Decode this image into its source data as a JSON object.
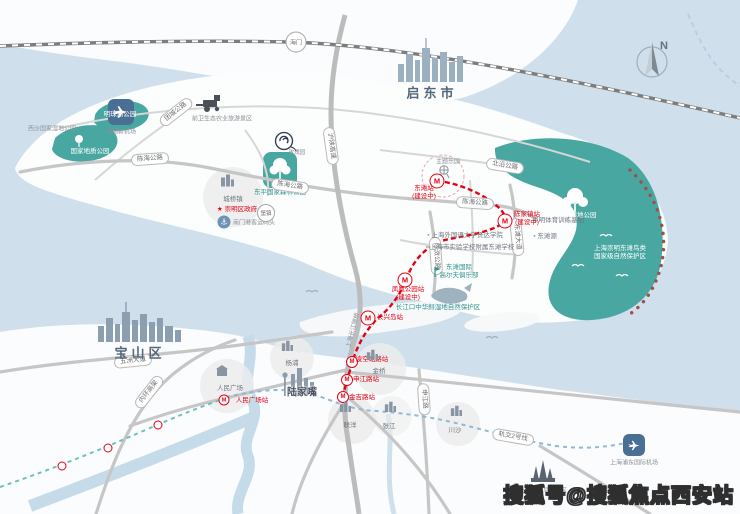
{
  "watermark": "搜狐号@搜狐焦点西安站",
  "compass": {
    "north": "N"
  },
  "regions": {
    "haimen": "海门",
    "qidong": "启东市",
    "baoshan": "宝山区",
    "chengqiao": "城桥镇",
    "baozhen": "堡镇",
    "district_gov": "崇明区政府",
    "renmin_square": "人民广场",
    "yangpu": "杨浦",
    "jinqiao": "金桥",
    "lujiazui": "陆家嘴",
    "lianyang": "联洋",
    "zhangjiang": "张江",
    "chuansha": "川沙"
  },
  "transport": {
    "nantong_airport": "南通新机场",
    "pudong_airport": "上海浦东国际机场",
    "nanmen_port": "南门港客运码头",
    "bridge": "上海长江隧桥",
    "metro2": "轨交2号线",
    "metro_logo": "M"
  },
  "roads": {
    "beiyan": "北沿公路",
    "chenhai": "陈海公路",
    "tuancheng": "团城公路",
    "dongtan_ave": "东滩大道",
    "chenxiao": "陈滧公路",
    "g40": "沪陕高速",
    "wuzhou": "五洲大道",
    "neihuan": "内环高架",
    "shenjiang": "申江路"
  },
  "stations": {
    "dongtan": "东滩站",
    "chenjiazhen": "陈家镇站",
    "fenghuang": "凤凰公园站",
    "changxing": "长兴岛站",
    "lingkong": "凌空北路站",
    "shenjiang": "申江路站",
    "jinji": "金吉路站",
    "renmin": "人民广场站",
    "note": "(建设中)"
  },
  "parks": {
    "mingzhu": "明珠湖公园",
    "xisha": "西沙国家湿地公园",
    "geo": "国家地质公园",
    "dongping": "东平国家森林公园",
    "dongtan_wetland": "东滩湿地公园",
    "bird_reserve_1": "上海崇明东滩鸟类",
    "bird_reserve_2": "国家级自然保护区",
    "qianwei": "前卫生态农业旅游景区",
    "theme_park": "主题乐园",
    "golf_1": "东滩国际",
    "golf_2": "高尔夫俱乐部",
    "sturgeon": "长江口中华鲟湿地自然保护区"
  },
  "pois": {
    "project": "玫瑰园",
    "sports": "崇明体育训练基地",
    "dongtanyuan": "东滩源",
    "school_1": "上海外国语大学贤达学院",
    "school_2": "上海市实验学校附属东滩学校",
    "disney": "上海迪士尼度假区"
  },
  "colors": {
    "water": "#cfe0ec",
    "park": "#49a7a1",
    "route_red": "#e60012"
  }
}
